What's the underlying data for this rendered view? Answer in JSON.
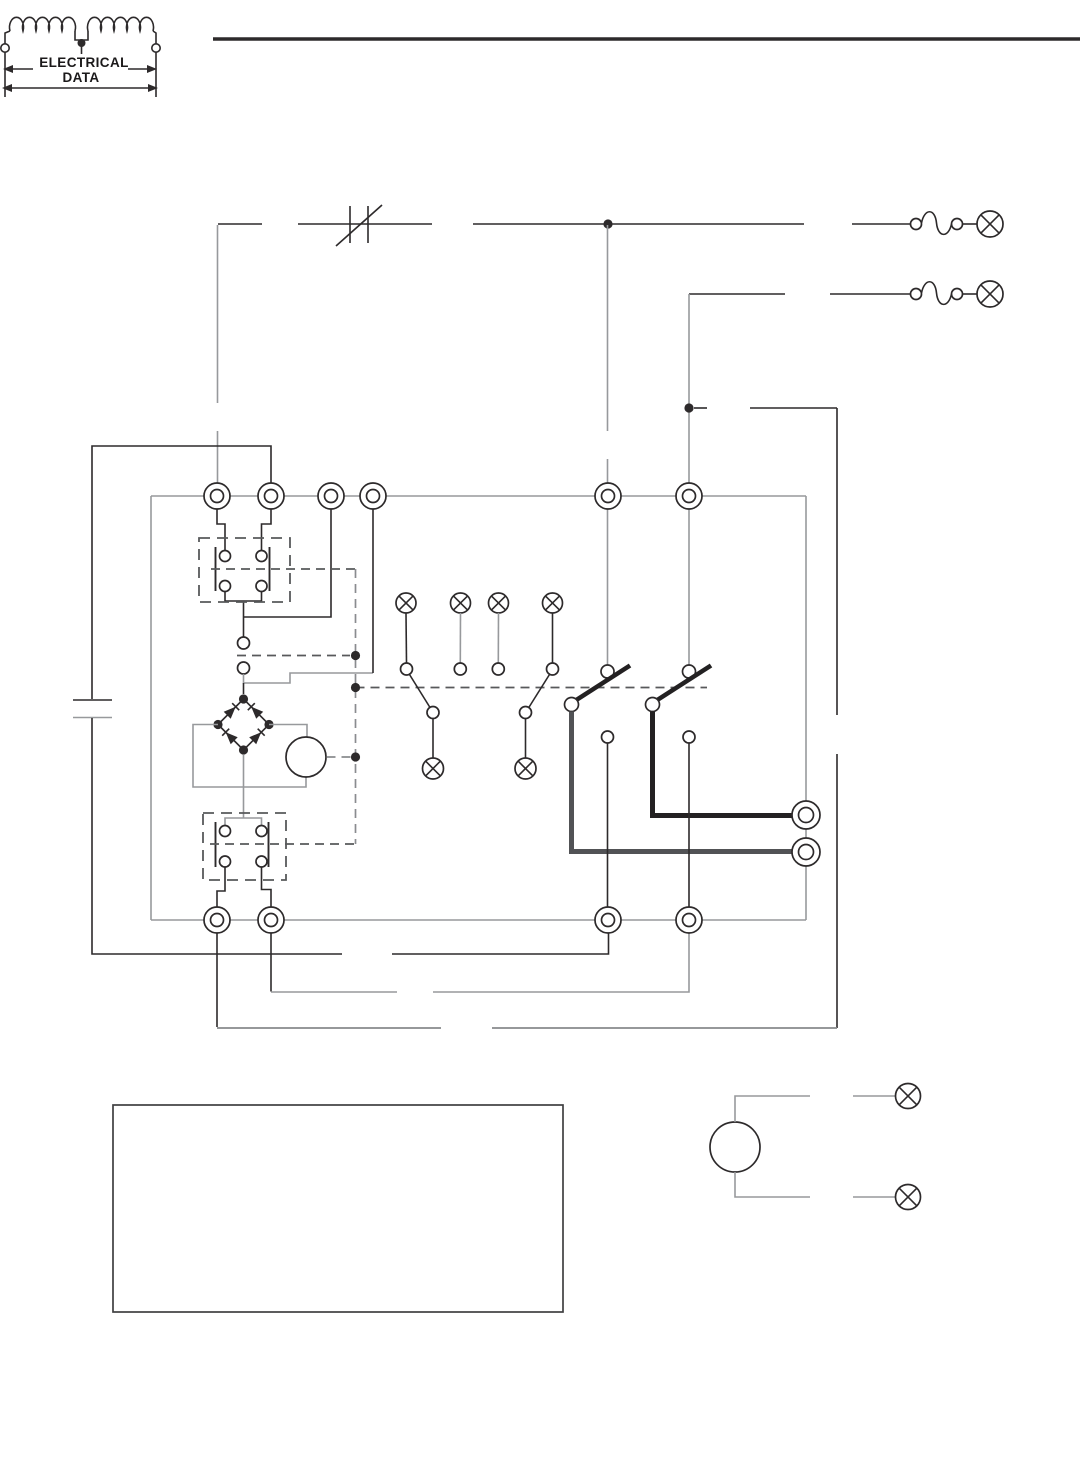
{
  "page": {
    "background": "#ffffff"
  },
  "logo": {
    "line1": "ELECTRICAL",
    "line2": "DATA"
  },
  "colors": {
    "ink": "#2d2a2b",
    "gray": "#97999c",
    "grayd": "#87898c",
    "dash": "#58595b",
    "heavy-a": "#515255",
    "heavy-b": "#232122",
    "bg": "#ffffff"
  }
}
